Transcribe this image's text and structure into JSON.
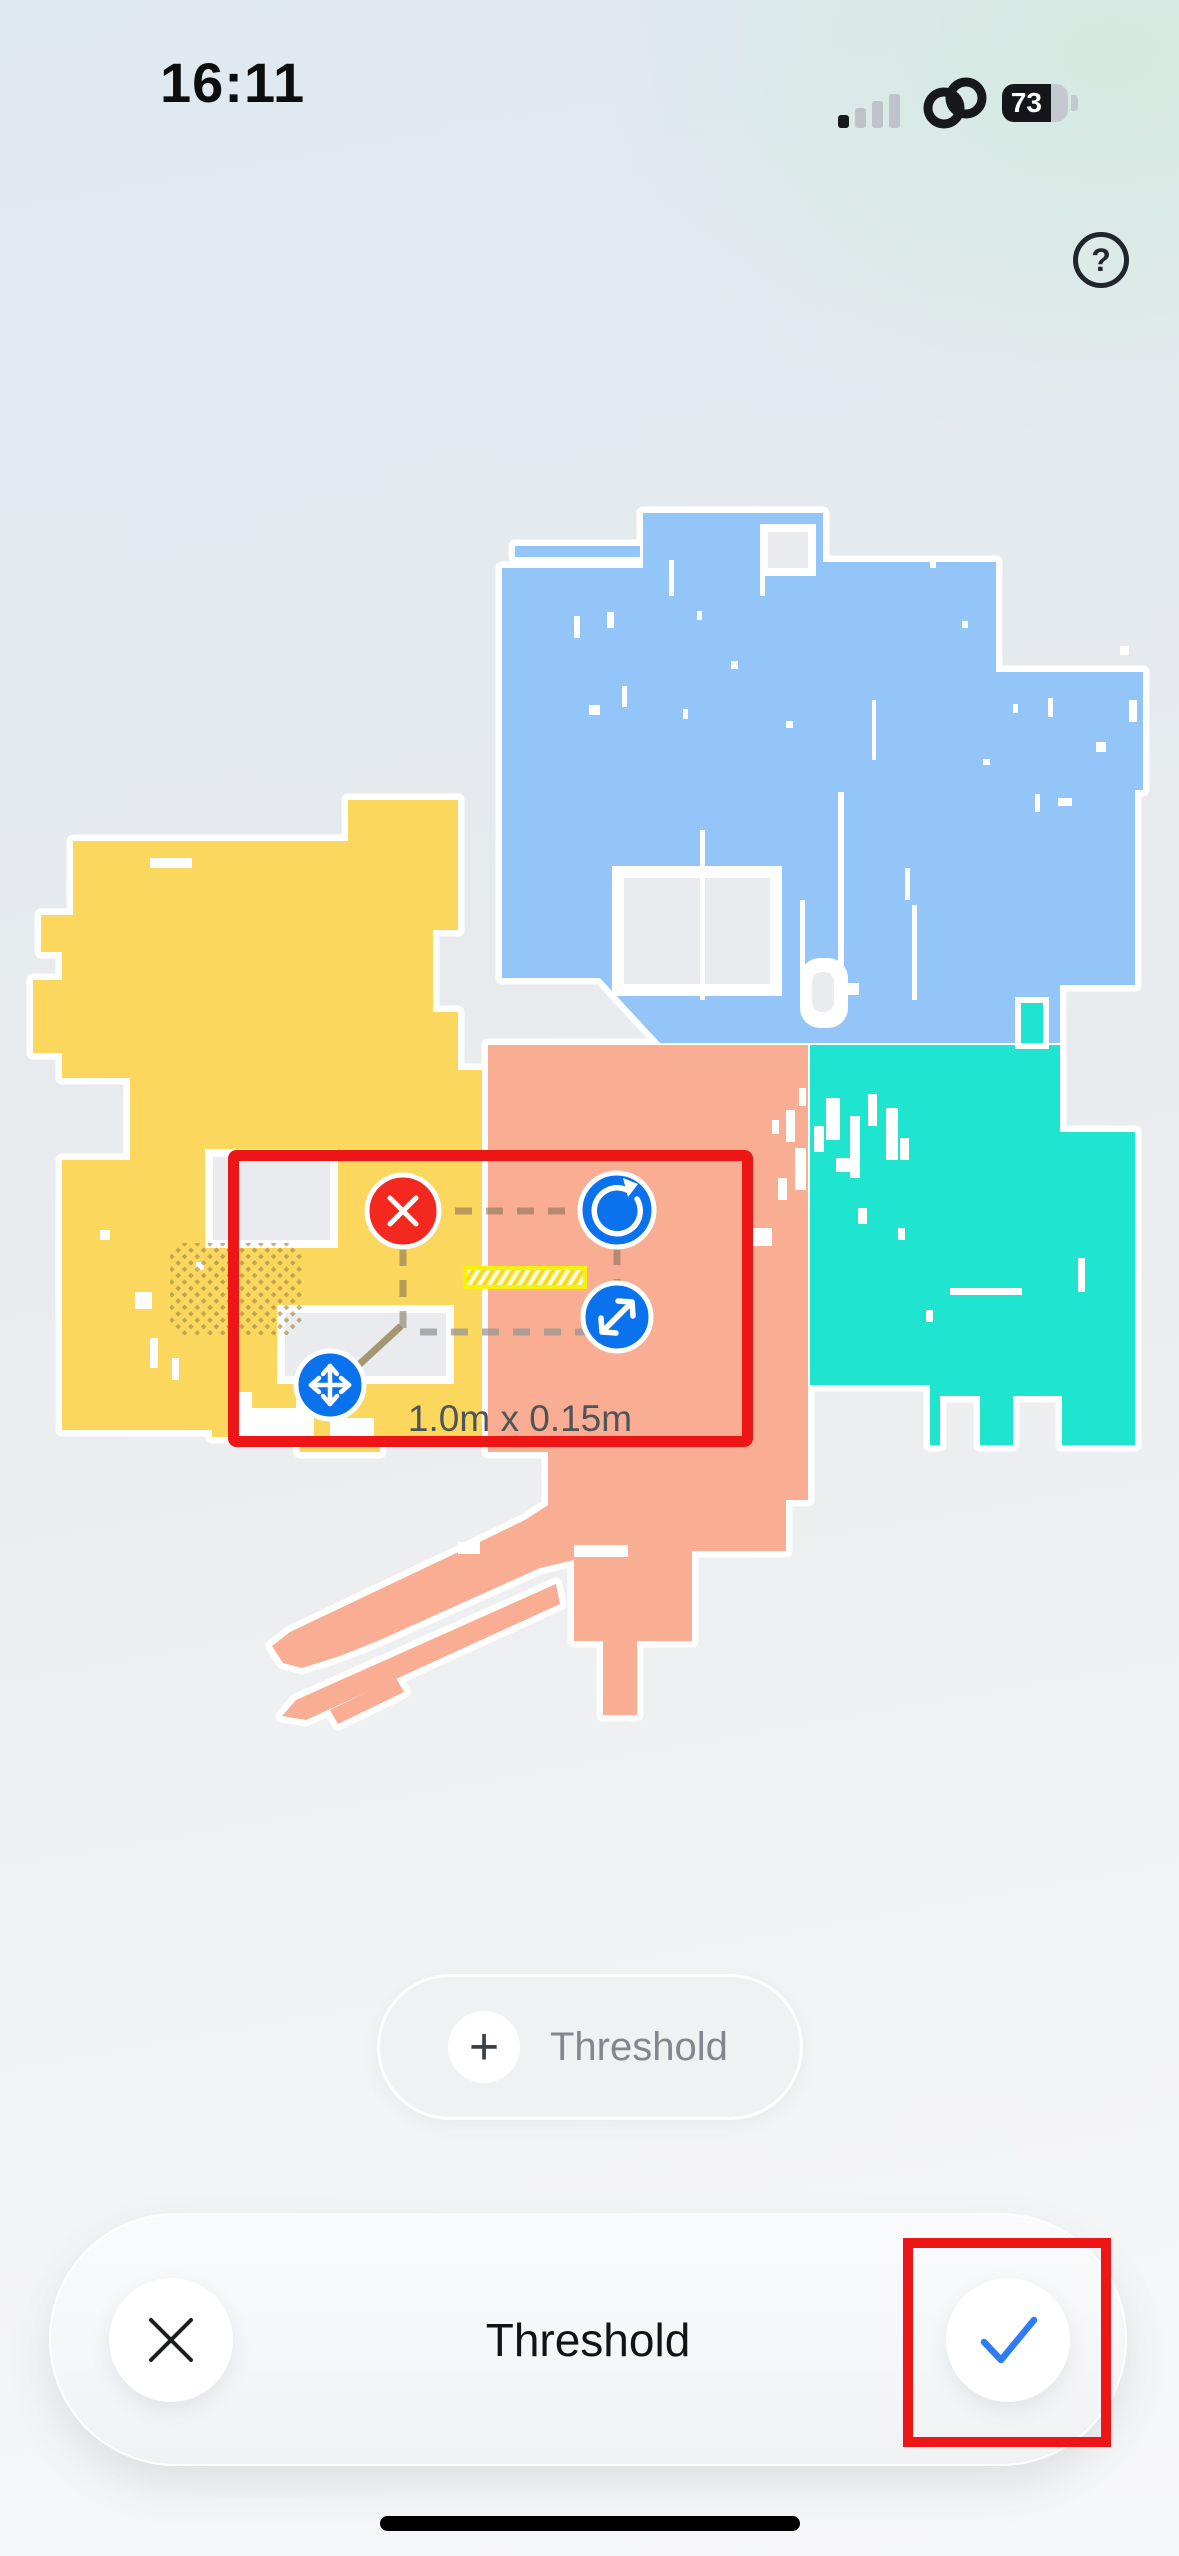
{
  "status_bar": {
    "time": "16:11",
    "battery_percent": "73",
    "signal_bars_filled": 1,
    "signal_bars_total": 4,
    "hotspot_icon": "linked-rings"
  },
  "header": {
    "help_icon": "?"
  },
  "map": {
    "colors": {
      "room_blue": "#93C5F8",
      "room_yellow": "#FBD75E",
      "room_salmon": "#F9AE93",
      "room_teal": "#1EE4D0",
      "background_hole": "#E9EBEE",
      "carpet_dot": "#AD9248",
      "threshold_yellow": "#F8F401"
    }
  },
  "selection": {
    "dimension_label": "1.0m x 0.15m",
    "box_color": "#ED1515",
    "handle_color": "#0B72EE",
    "delete_color": "#F3291F",
    "handles": [
      "delete",
      "rotate",
      "resize",
      "move"
    ]
  },
  "add_threshold_button": {
    "plus_icon": "+",
    "label": "Threshold"
  },
  "bottom_bar": {
    "title": "Threshold",
    "cancel_icon": "close-x",
    "confirm_icon": "checkmark",
    "confirm_color": "#2E7BF6"
  },
  "annotation": {
    "color": "#ED1515"
  }
}
